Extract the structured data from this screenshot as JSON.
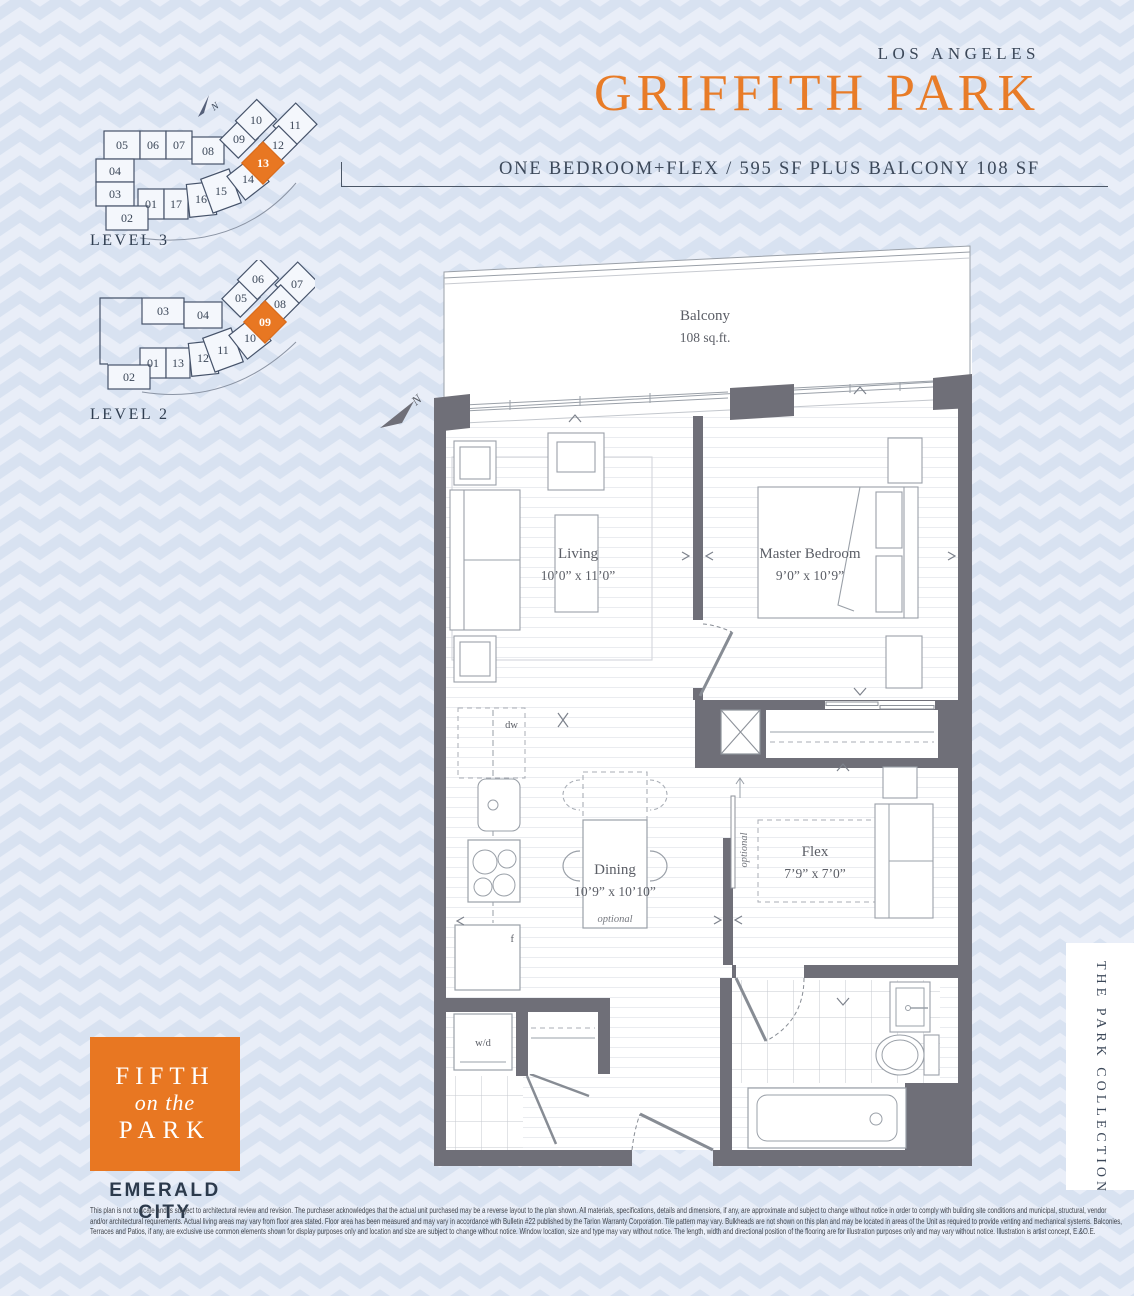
{
  "header": {
    "city": "LOS ANGELES",
    "plan_name": "GRIFFITH PARK",
    "subtitle": "ONE BEDROOM+FLEX / 595 SF PLUS BALCONY 108 SF"
  },
  "keyplans": {
    "level3": {
      "label": "LEVEL 3",
      "highlighted_unit": "13",
      "units": [
        "05",
        "06",
        "07",
        "08",
        "04",
        "03",
        "01",
        "17",
        "16",
        "02",
        "15",
        "14",
        "09",
        "10",
        "11",
        "12",
        "13"
      ]
    },
    "level2": {
      "label": "LEVEL 2",
      "highlighted_unit": "09",
      "units": [
        "03",
        "04",
        "01",
        "13",
        "12",
        "02",
        "11",
        "10",
        "05",
        "06",
        "07",
        "08",
        "09"
      ]
    }
  },
  "plan": {
    "north_label": "N",
    "balcony": {
      "name": "Balcony",
      "area": "108 sq.ft."
    },
    "rooms": [
      {
        "name": "Living",
        "dims": "10’0” x 11’0”"
      },
      {
        "name": "Master Bedroom",
        "dims": "9’0” x 10’9”"
      },
      {
        "name": "Dining",
        "dims": "10’9” x 10’10”",
        "note": "optional"
      },
      {
        "name": "Flex",
        "dims": "7’9” x 7’0”",
        "note": "optional"
      }
    ],
    "fixtures": {
      "dishwasher": "dw",
      "fridge": "f",
      "washer_dryer": "w/d"
    }
  },
  "branding": {
    "logo": {
      "line1": "FIFTH",
      "line2": "on the",
      "line3": "PARK"
    },
    "developer": "EMERALD CITY",
    "collection": "THE PARK COLLECTION"
  },
  "disclaimer": {
    "line1": "This plan is not to scale and is subject to architectural review and revision. The purchaser acknowledges that the actual unit purchased may be a reverse layout to the plan shown. All materials, specifications, details and dimensions, if any, are approximate and subject to change without notice in order to comply with building site conditions and municipal, structural, vendor",
    "line2": "and/or architectural requirements. Actual living areas may vary from floor area stated. Floor area has been measured and may vary in accordance with Bulletin #22 published by the Tarion Warranty Corporation. Tile pattern may vary. Bulkheads are not shown on this plan and may be located in areas of the Unit as required to provide venting and mechanical systems. Balconies,",
    "line3": "Terraces and Patios, if any, are exclusive use common elements shown for display purposes only and location and size are subject to change without notice. Window location, size and type may vary without notice. The length, width and directional position of the flooring are for illustration purposes only and may vary without notice. Illustration is artist concept, E.&O.E."
  },
  "colors": {
    "accent": "#e87722",
    "wall": "#6f6f78",
    "navy": "#3c4859",
    "chevron_light": "#e9eef8",
    "chevron_dark": "#d8e2f1"
  }
}
